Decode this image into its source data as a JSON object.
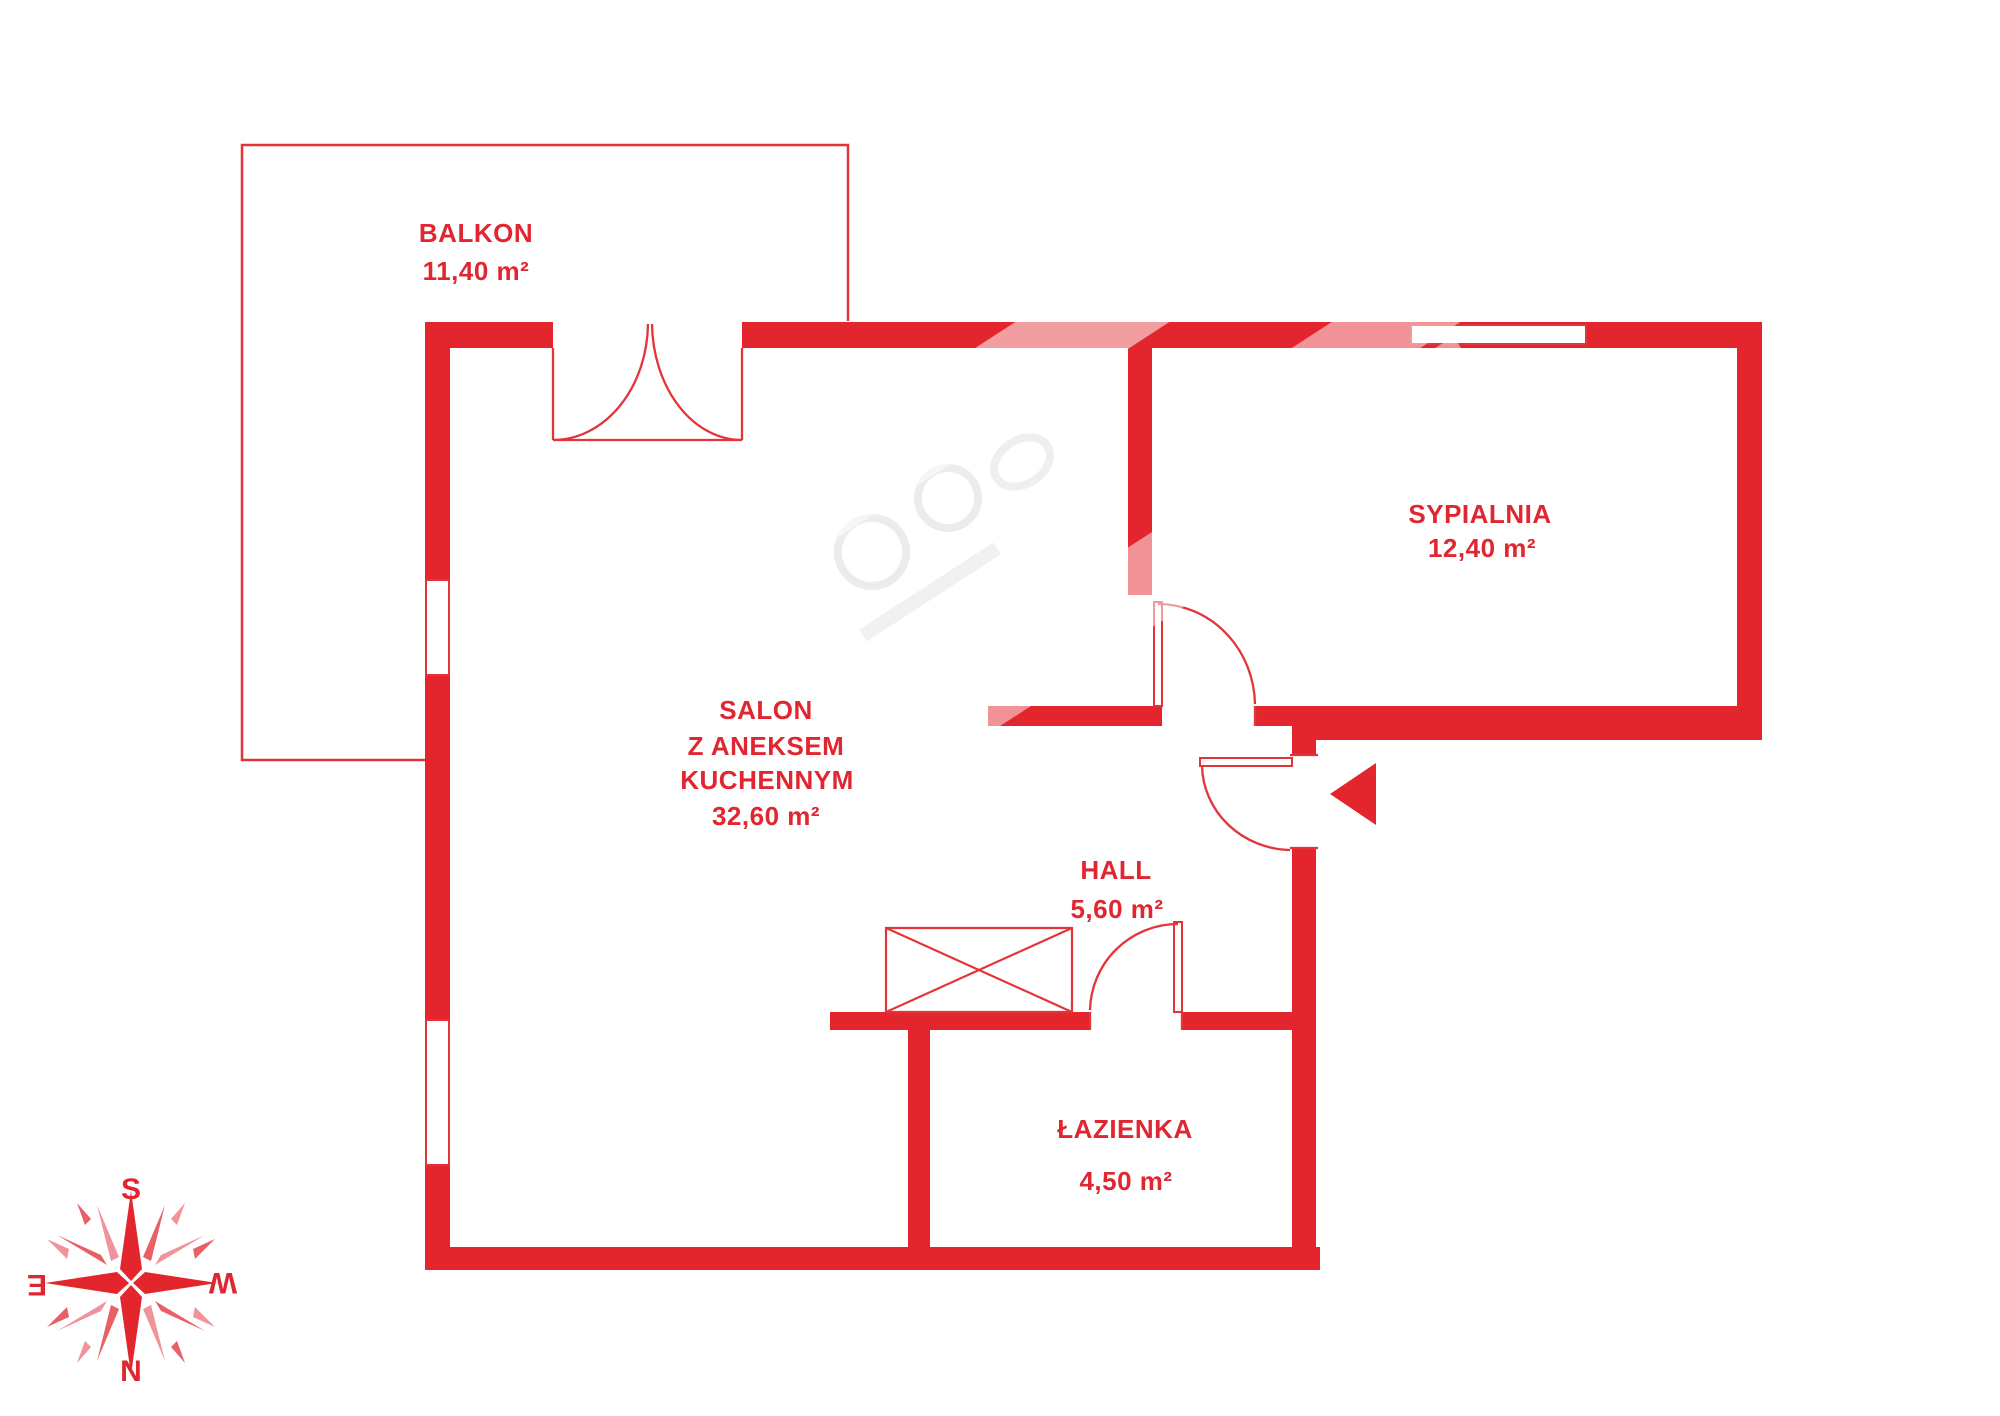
{
  "plan_title": "apartment floor plan",
  "rooms": {
    "balkon": {
      "name": "BALKON",
      "area": "11,40 m²"
    },
    "salon": {
      "name_lines": [
        "SALON",
        "Z ANEKSEM",
        "KUCHENNYM"
      ],
      "area": "32,60 m²"
    },
    "sypialnia": {
      "name": "SYPIALNIA",
      "area": "12,40 m²"
    },
    "hall": {
      "name": "HALL",
      "area": "5,60 m²"
    },
    "lazienka": {
      "name": "ŁAZIENKA",
      "area": "4,50 m²"
    }
  },
  "compass": {
    "top": "S",
    "bottom": "N",
    "left": "E",
    "right": "W"
  },
  "colors": {
    "wall_red": "#e3262d",
    "text_red": "#e02630",
    "shard_light": "#f0939a",
    "shard_mid": "#e95f66",
    "watermark_gray": "#ececec"
  }
}
